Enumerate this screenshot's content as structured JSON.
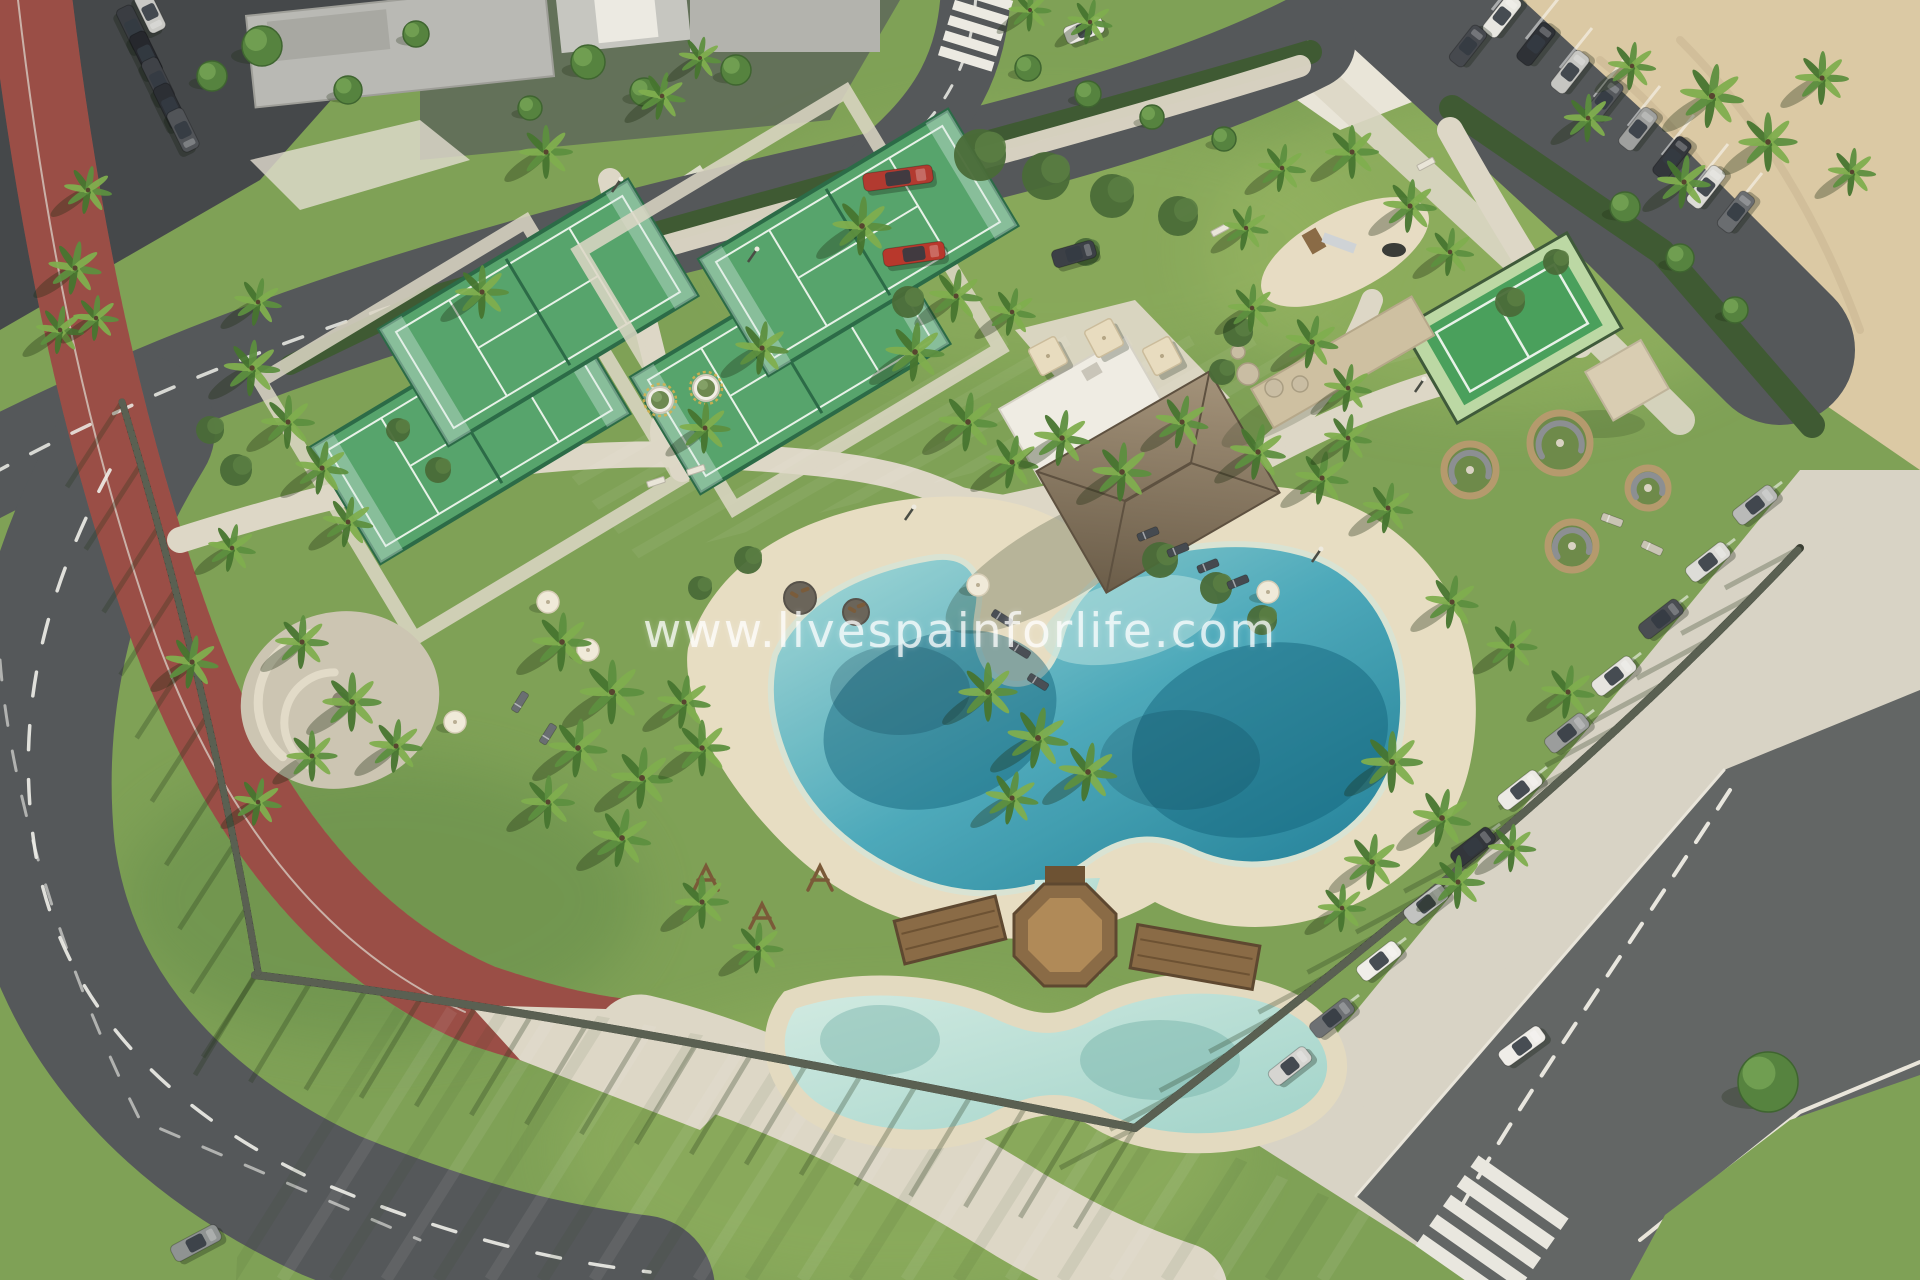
{
  "watermark": {
    "text": "www.livespainforlife.com"
  },
  "colors": {
    "grass": "#7fa156",
    "grass_light": "#9ab764",
    "grass_dark": "#5f8747",
    "asphalt": "#55585a",
    "asphalt_dark": "#45484a",
    "asphalt_mid": "#636665",
    "road_line": "#efefe9",
    "track_red": "#a5574e",
    "track_dark": "#8e453e",
    "path": "#ddd7c6",
    "paver": "#d8d3c5",
    "sand": "#dbc9a4",
    "beach": "#e7ddc2",
    "hedge": "#3f5a33",
    "court_turf": "#57a46c",
    "court_turf_light": "#79bb8b",
    "court_frame": "#2c6b47",
    "court_surround": "#bcd8a4",
    "pool_shallow": "#a9dcda",
    "pool_mid": "#49a8ba",
    "pool_deep": "#1a7a94",
    "kids_pool_light": "#d3ebe2",
    "kids_pool": "#9fd2c8",
    "thatch_light": "#a4937a",
    "thatch_dark": "#6b5d49",
    "wood": "#8a6b46",
    "wood_dark": "#6d5233",
    "fence": "#3a3e33",
    "fence_slat": "#5a6052",
    "white_building": "#efece3",
    "stone_wall": "#cec0a1",
    "tree_green": "#56833f",
    "tree_highlight": "#74a355",
    "palm_a": "#5d8f3f",
    "palm_b": "#7fae4e",
    "palm_c": "#47752f",
    "shrub": "#4a6b38",
    "shadow": "rgba(26,42,16,0.33)"
  },
  "vegetation": {
    "palms": [
      [
        88,
        190,
        0.9
      ],
      [
        75,
        268,
        1
      ],
      [
        60,
        330,
        0.9
      ],
      [
        96,
        318,
        0.85
      ],
      [
        258,
        302,
        0.9
      ],
      [
        252,
        368,
        1.05
      ],
      [
        288,
        422,
        1
      ],
      [
        322,
        468,
        1
      ],
      [
        348,
        522,
        0.95
      ],
      [
        232,
        548,
        0.9
      ],
      [
        192,
        662,
        1
      ],
      [
        302,
        642,
        1
      ],
      [
        352,
        702,
        1.1
      ],
      [
        396,
        746,
        1
      ],
      [
        312,
        756,
        0.95
      ],
      [
        258,
        802,
        0.9
      ],
      [
        546,
        152,
        1
      ],
      [
        482,
        292,
        1
      ],
      [
        662,
        96,
        0.9
      ],
      [
        700,
        58,
        0.8
      ],
      [
        862,
        226,
        1.1
      ],
      [
        956,
        296,
        1
      ],
      [
        1012,
        312,
        0.9
      ],
      [
        1090,
        22,
        0.85
      ],
      [
        1030,
        10,
        0.8
      ],
      [
        762,
        348,
        1
      ],
      [
        705,
        428,
        0.95
      ],
      [
        915,
        352,
        1.1
      ],
      [
        968,
        422,
        1.1
      ],
      [
        1012,
        462,
        1
      ],
      [
        1062,
        438,
        1.05
      ],
      [
        1122,
        472,
        1.1
      ],
      [
        1182,
        422,
        1
      ],
      [
        1258,
        452,
        1.05
      ],
      [
        1322,
        478,
        1
      ],
      [
        1388,
        508,
        0.95
      ],
      [
        1348,
        438,
        0.9
      ],
      [
        1252,
        308,
        0.9
      ],
      [
        1312,
        342,
        1
      ],
      [
        1348,
        388,
        0.9
      ],
      [
        1282,
        168,
        0.9
      ],
      [
        1352,
        152,
        1
      ],
      [
        1410,
        206,
        1
      ],
      [
        1450,
        252,
        0.9
      ],
      [
        1246,
        228,
        0.85
      ],
      [
        1712,
        96,
        1.2
      ],
      [
        1768,
        142,
        1.1
      ],
      [
        1822,
        78,
        1
      ],
      [
        1632,
        66,
        0.9
      ],
      [
        1588,
        118,
        0.9
      ],
      [
        1684,
        182,
        1
      ],
      [
        1852,
        172,
        0.9
      ],
      [
        1452,
        602,
        1
      ],
      [
        1512,
        646,
        0.95
      ],
      [
        1568,
        692,
        1
      ],
      [
        562,
        642,
        1.1
      ],
      [
        612,
        692,
        1.2
      ],
      [
        578,
        748,
        1.1
      ],
      [
        642,
        778,
        1.15
      ],
      [
        702,
        748,
        1.05
      ],
      [
        548,
        802,
        1
      ],
      [
        622,
        838,
        1.1
      ],
      [
        684,
        702,
        1
      ],
      [
        988,
        692,
        1.1
      ],
      [
        1038,
        738,
        1.15
      ],
      [
        1088,
        772,
        1.1
      ],
      [
        1012,
        798,
        1
      ],
      [
        1392,
        762,
        1.15
      ],
      [
        1442,
        818,
        1.1
      ],
      [
        1372,
        862,
        1.05
      ],
      [
        1458,
        882,
        1
      ],
      [
        1512,
        848,
        0.9
      ],
      [
        1342,
        908,
        0.9
      ],
      [
        702,
        902,
        1
      ],
      [
        758,
        948,
        0.95
      ]
    ],
    "trees": [
      [
        262,
        46,
        20
      ],
      [
        212,
        76,
        15
      ],
      [
        348,
        90,
        14
      ],
      [
        416,
        34,
        13
      ],
      [
        588,
        62,
        17
      ],
      [
        644,
        92,
        14
      ],
      [
        736,
        70,
        15
      ],
      [
        530,
        108,
        12
      ],
      [
        1028,
        68,
        13
      ],
      [
        1088,
        94,
        13
      ],
      [
        1152,
        117,
        12
      ],
      [
        1224,
        139,
        12
      ],
      [
        1625,
        207,
        15
      ],
      [
        1680,
        258,
        14
      ],
      [
        1735,
        310,
        13
      ],
      [
        1768,
        1082,
        30
      ]
    ],
    "shrubs": [
      [
        980,
        155,
        26
      ],
      [
        1046,
        176,
        24
      ],
      [
        1112,
        196,
        22
      ],
      [
        1178,
        216,
        20
      ],
      [
        908,
        302,
        16
      ],
      [
        1238,
        332,
        15
      ],
      [
        1222,
        372,
        13
      ],
      [
        1510,
        302,
        15
      ],
      [
        1556,
        262,
        13
      ],
      [
        1160,
        560,
        18
      ],
      [
        1216,
        588,
        16
      ],
      [
        1262,
        620,
        15
      ],
      [
        748,
        560,
        14
      ],
      [
        700,
        588,
        12
      ],
      [
        438,
        470,
        13
      ],
      [
        398,
        430,
        12
      ],
      [
        1086,
        252,
        14
      ],
      [
        236,
        470,
        16
      ],
      [
        210,
        430,
        14
      ]
    ]
  },
  "vehicles": {
    "cars": [
      [
        150,
        12,
        64,
        42,
        "#c9c9c5"
      ],
      [
        133,
        28,
        64,
        46,
        "#3a3d42"
      ],
      [
        146,
        54,
        64,
        46,
        "#26282d"
      ],
      [
        158,
        80,
        64,
        46,
        "#3f4247"
      ],
      [
        170,
        106,
        64,
        46,
        "#2c2f34"
      ],
      [
        183,
        130,
        64,
        44,
        "#515458"
      ],
      [
        898,
        178,
        -8,
        70,
        "#b23a30"
      ],
      [
        914,
        254,
        -8,
        62,
        "#b8382c"
      ],
      [
        1074,
        254,
        -16,
        44,
        "#3c4046"
      ],
      [
        1084,
        30,
        -20,
        40,
        "#eceae4"
      ],
      [
        1502,
        16,
        -52,
        46,
        "#e8e7e1"
      ],
      [
        1536,
        44,
        -52,
        46,
        "#2e3136"
      ],
      [
        1570,
        72,
        -52,
        46,
        "#c6c6c2"
      ],
      [
        1604,
        100,
        -52,
        46,
        "#55585c"
      ],
      [
        1638,
        129,
        -52,
        46,
        "#9fa09e"
      ],
      [
        1672,
        158,
        -52,
        46,
        "#33363b"
      ],
      [
        1706,
        187,
        -52,
        46,
        "#dcdbd6"
      ],
      [
        1736,
        212,
        -52,
        44,
        "#6a6d70"
      ],
      [
        1468,
        46,
        -52,
        44,
        "#46494e"
      ],
      [
        1755,
        505,
        -38,
        48,
        "#b9bab8"
      ],
      [
        1708,
        562,
        -38,
        48,
        "#dddcd7"
      ],
      [
        1661,
        619,
        -38,
        48,
        "#4a4d52"
      ],
      [
        1614,
        676,
        -38,
        48,
        "#e6e4df"
      ],
      [
        1567,
        733,
        -38,
        48,
        "#9b9d9c"
      ],
      [
        1520,
        790,
        -38,
        48,
        "#eceae5"
      ],
      [
        1473,
        847,
        -38,
        48,
        "#33363b"
      ],
      [
        1426,
        904,
        -38,
        48,
        "#c2c3c1"
      ],
      [
        1379,
        961,
        -38,
        48,
        "#f0eee9"
      ],
      [
        1332,
        1018,
        -38,
        48,
        "#6d7073"
      ],
      [
        1290,
        1066,
        -38,
        46,
        "#d6d5d1"
      ],
      [
        1522,
        1046,
        -36,
        50,
        "#efede8"
      ],
      [
        196,
        1243,
        -28,
        52,
        "#8f9392"
      ]
    ]
  },
  "furniture": {
    "loungers": [
      [
        1002,
        618,
        32,
        "#4a4f55"
      ],
      [
        1020,
        650,
        32,
        "#4a4f55"
      ],
      [
        1038,
        682,
        32,
        "#4a4f55"
      ],
      [
        1148,
        534,
        -22,
        "#454a50"
      ],
      [
        1178,
        550,
        -22,
        "#454a50"
      ],
      [
        1208,
        566,
        -22,
        "#454a50"
      ],
      [
        1238,
        582,
        -22,
        "#454a50"
      ],
      [
        520,
        702,
        -58,
        "#6a6e72"
      ],
      [
        548,
        734,
        -58,
        "#6a6e72"
      ],
      [
        1612,
        520,
        20,
        "#c9c4b4"
      ],
      [
        1652,
        548,
        25,
        "#c9c4b4"
      ]
    ],
    "umbrellas": [
      [
        978,
        585
      ],
      [
        1268,
        592
      ],
      [
        548,
        602
      ],
      [
        588,
        650
      ],
      [
        455,
        722
      ]
    ],
    "bar_canopies": [
      [
        1048,
        356
      ],
      [
        1104,
        338
      ],
      [
        1162,
        356
      ]
    ],
    "benches": [
      [
        656,
        482,
        -18
      ],
      [
        696,
        470,
        -18
      ],
      [
        1184,
        212,
        -28
      ],
      [
        1220,
        230,
        -28
      ],
      [
        1426,
        164,
        -28
      ]
    ],
    "planters": [
      [
        660,
        400
      ],
      [
        706,
        388
      ]
    ],
    "seating_pods": [
      [
        1470,
        470,
        26
      ],
      [
        1560,
        443,
        30
      ],
      [
        1572,
        546,
        24
      ],
      [
        1648,
        488,
        20
      ]
    ],
    "lamp_posts": [
      [
        612,
        192
      ],
      [
        748,
        262
      ],
      [
        1010,
        320
      ],
      [
        905,
        520
      ],
      [
        1312,
        562
      ],
      [
        1415,
        392
      ]
    ],
    "mulch_circles": [
      [
        800,
        598,
        16
      ],
      [
        856,
        612,
        13
      ]
    ],
    "swing_frames": [
      [
        706,
        878
      ],
      [
        762,
        916
      ],
      [
        820,
        878
      ]
    ],
    "boulders": [
      [
        1248,
        374,
        11
      ],
      [
        1274,
        388,
        9
      ],
      [
        1300,
        384,
        8
      ],
      [
        1238,
        352,
        7
      ]
    ]
  }
}
